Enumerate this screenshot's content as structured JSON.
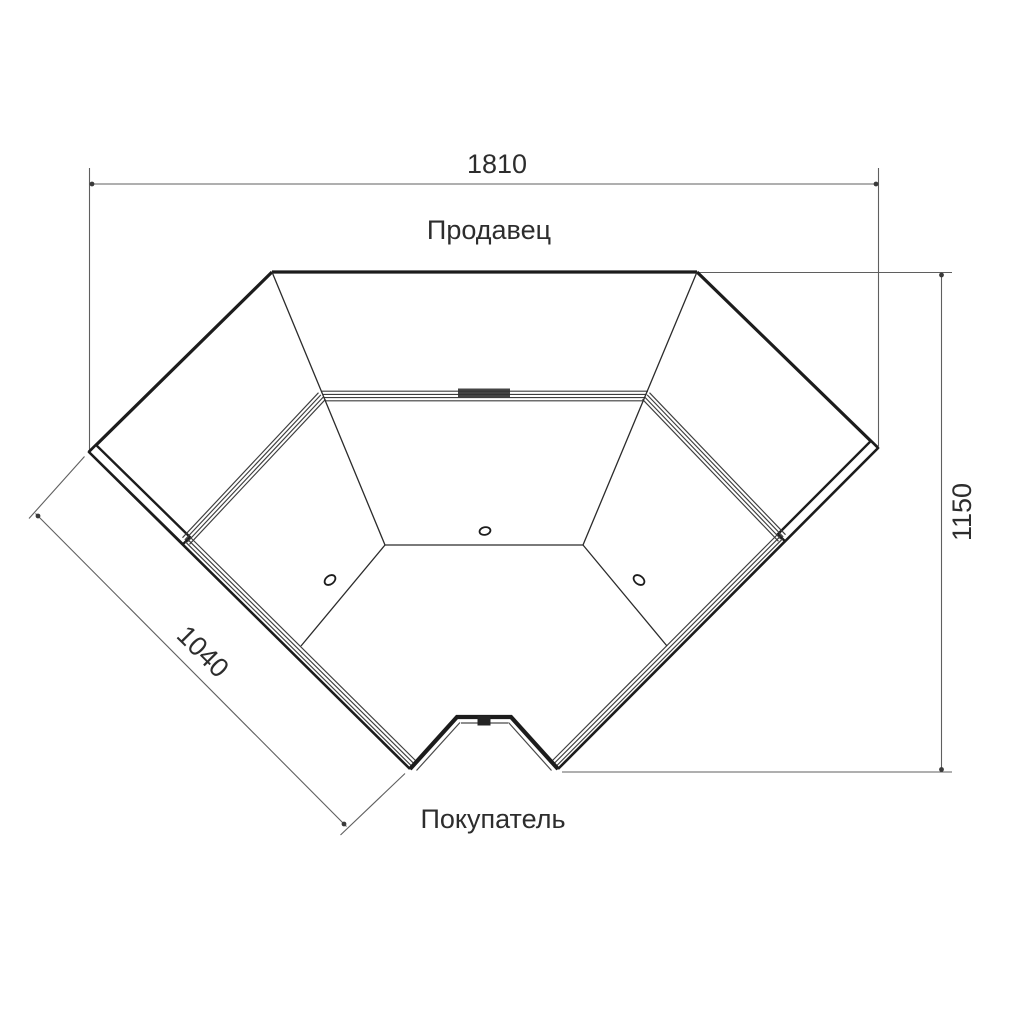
{
  "drawing": {
    "type": "plan-view technical drawing of corner display counter",
    "labels": {
      "seller": "Продавец",
      "buyer": "Покупатель"
    },
    "dimensions": {
      "top_width": "1810",
      "right_height": "1150",
      "left_front_depth": "1040"
    },
    "colors": {
      "background": "#ffffff",
      "outline": "#1c1c1c",
      "strip_lines": "#3d3d3d",
      "seam_lines": "#2b2b2b",
      "dimension_lines": "#5f5f5f",
      "text": "#2d2d2d"
    }
  }
}
